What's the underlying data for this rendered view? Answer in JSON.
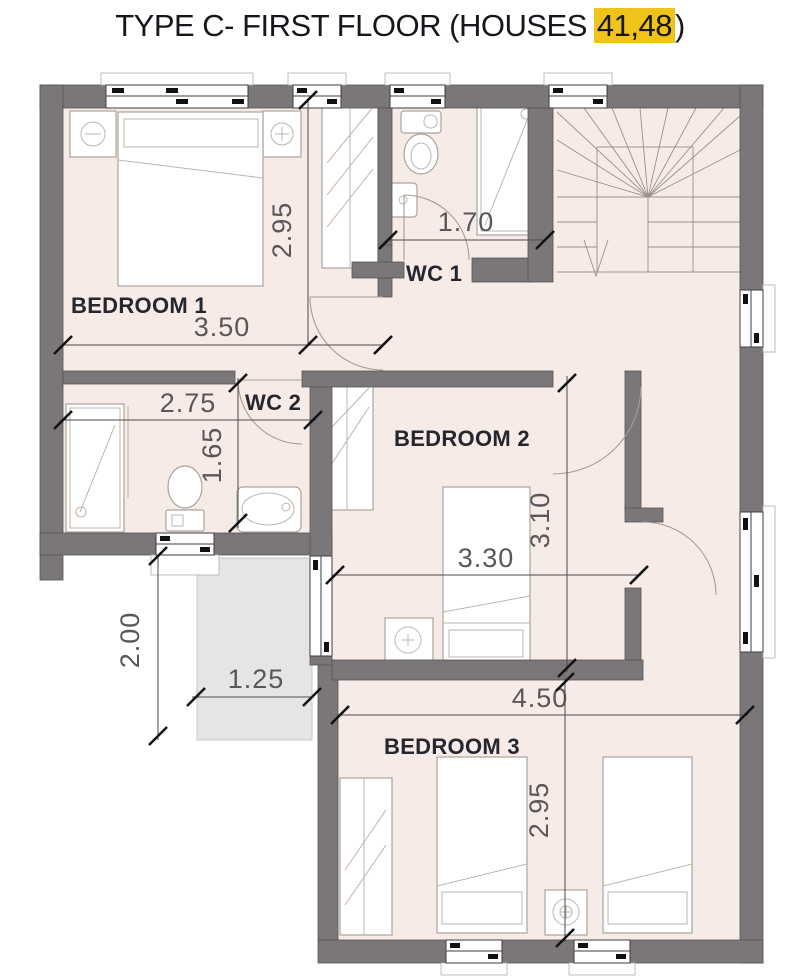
{
  "title": {
    "prefix": "TYPE C- FIRST FLOOR (HOUSES",
    "highlight": "41,48",
    "suffix": ")"
  },
  "rooms": {
    "bedroom1": {
      "label": "BEDROOM 1",
      "width_m": "3.50",
      "height_m": "2.95"
    },
    "wc1": {
      "label": "WC 1",
      "width_m": "1.70"
    },
    "wc2": {
      "label": "WC 2",
      "width_m": "2.75",
      "height_m": "1.65"
    },
    "bedroom2": {
      "label": "BEDROOM 2",
      "width_m": "3.30",
      "height_m": "3.10"
    },
    "bedroom3": {
      "label": "BEDROOM 3",
      "width_m": "4.50",
      "height_m": "2.95"
    },
    "terrace": {
      "width_m": "1.25",
      "height_m": "2.00"
    }
  },
  "colors": {
    "wall": "#7b7779",
    "floor": "#f6ebe7",
    "terrace": "#e6e5e6",
    "highlight": "#efc31a",
    "dim_text": "#5a5659",
    "label_text": "#26262e"
  }
}
